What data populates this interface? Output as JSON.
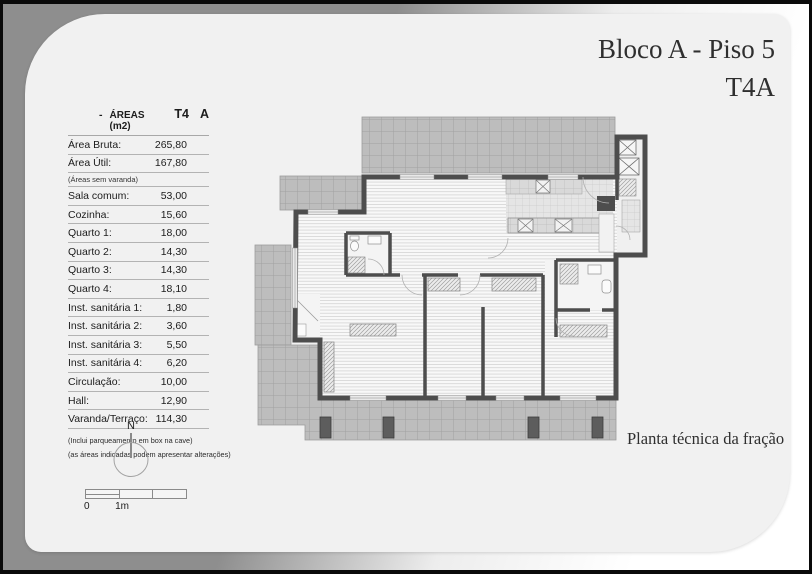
{
  "header": {
    "title_line1": "Bloco A - Piso 5",
    "title_line2": "T4A"
  },
  "caption": "Planta técnica da fração",
  "areas_table": {
    "header": {
      "dash": "-",
      "label": "ÁREAS (m2)",
      "col1": "T4",
      "col2": "A"
    },
    "rows": [
      {
        "label": "Área Bruta:",
        "value": "265,80"
      },
      {
        "label": "Área Útil:",
        "value": "167,80"
      },
      {
        "label": "(Áreas sem varanda)",
        "value": "",
        "note": true
      },
      {
        "label": "Sala comum:",
        "value": "53,00"
      },
      {
        "label": "Cozinha:",
        "value": "15,60"
      },
      {
        "label": "Quarto 1:",
        "value": "18,00"
      },
      {
        "label": "Quarto 2:",
        "value": "14,30"
      },
      {
        "label": "Quarto 3:",
        "value": "14,30"
      },
      {
        "label": "Quarto 4:",
        "value": "18,10"
      },
      {
        "label": "Inst. sanitária 1:",
        "value": "1,80"
      },
      {
        "label": "Inst. sanitária 2:",
        "value": "3,60"
      },
      {
        "label": "Inst. sanitária 3:",
        "value": "5,50"
      },
      {
        "label": "Inst. sanitária 4:",
        "value": "6,20"
      },
      {
        "label": "Circulação:",
        "value": "10,00"
      },
      {
        "label": "Hall:",
        "value": "12,90"
      },
      {
        "label": "Varanda/Terraço:",
        "value": "114,30"
      }
    ],
    "footnotes": [
      "(Inclui parqueamento em box na cave)",
      "(as áreas indicadas podem apresentar alterações)"
    ]
  },
  "north_indicator": {
    "label": "N"
  },
  "scale_bar": {
    "zero": "0",
    "one_meter": "1m"
  },
  "colors": {
    "wall": "#4d4d4d",
    "terrace_fill": "#bdbdbd",
    "page": "#f1f1f1",
    "surround_gray": "#8e8e8e"
  }
}
